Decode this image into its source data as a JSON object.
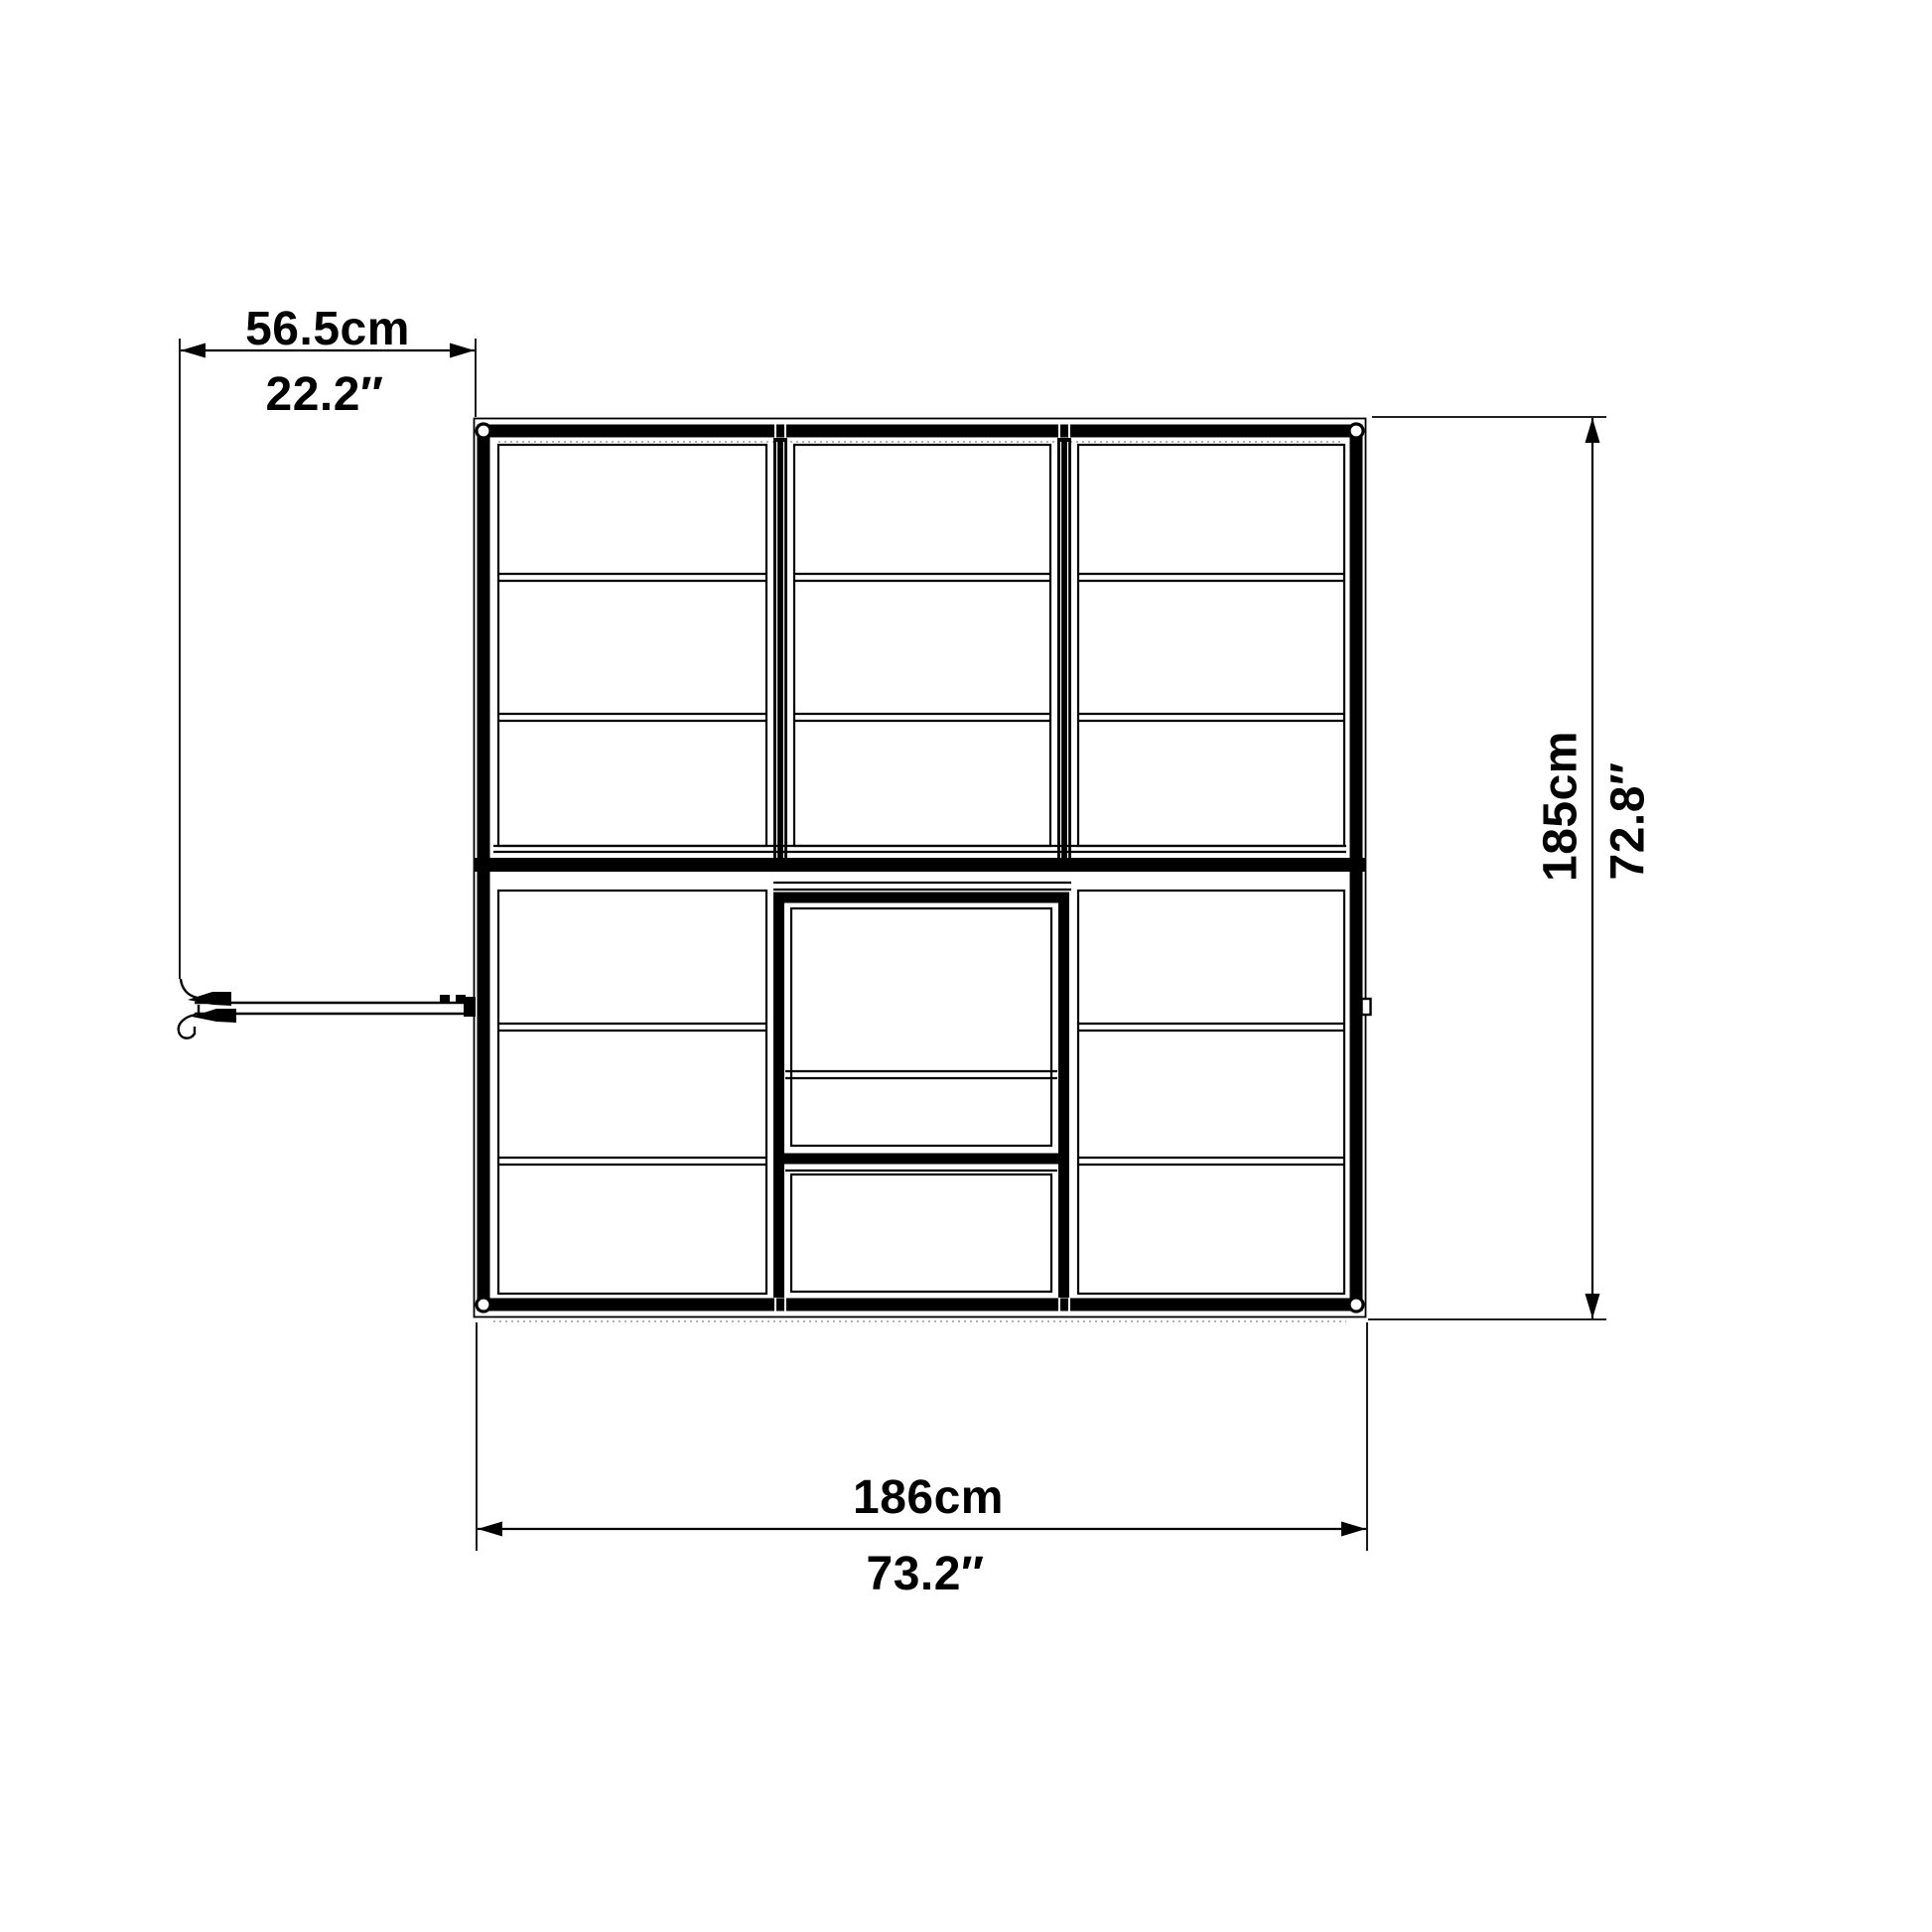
{
  "drawing": {
    "type": "greenhouse-floor-plan-top-view",
    "colors": {
      "line": "#000000",
      "background": "#ffffff",
      "shadow_dotted": "#9a9a9a"
    },
    "dimensions": {
      "door_swing": {
        "cm": "56.5cm",
        "inches": "22.2″"
      },
      "depth": {
        "cm": "185cm",
        "inches": "72.8″"
      },
      "width": {
        "cm": "186cm",
        "inches": "73.2″"
      }
    }
  }
}
